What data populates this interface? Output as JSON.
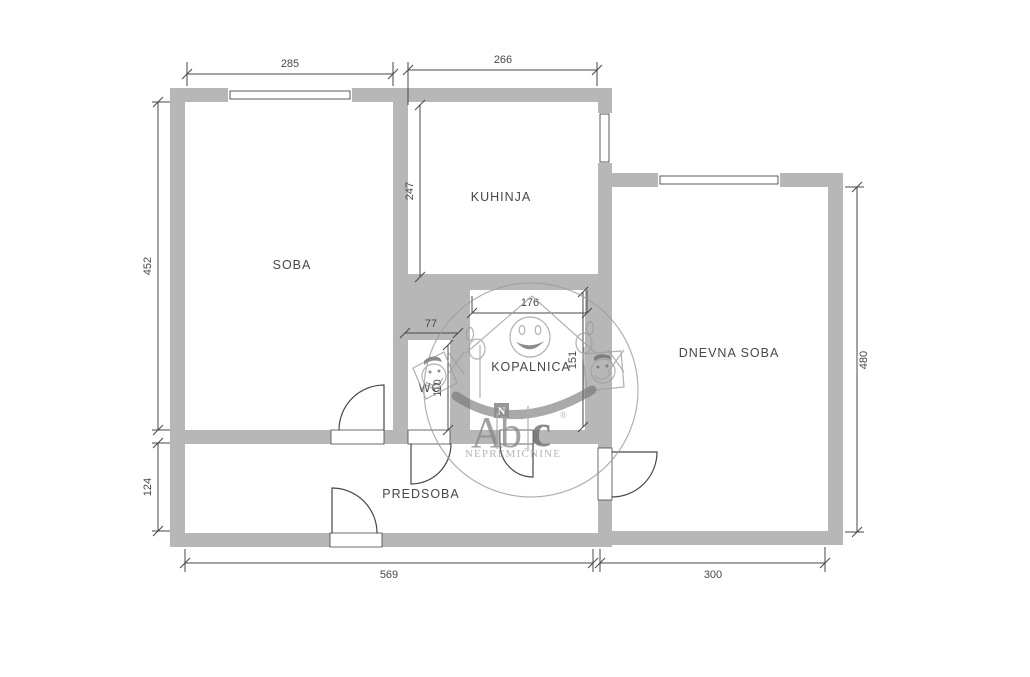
{
  "rooms": {
    "soba": "SOBA",
    "kuhinja": "KUHINJA",
    "kopalnica": "KOPALNICA",
    "wc": "WC",
    "predsoba": "PREDSOBA",
    "dnevna_soba": "DNEVNA SOBA"
  },
  "dims": {
    "soba_width": "285",
    "kuhinja_width": "266",
    "kuhinja_height": "247",
    "soba_height": "452",
    "predsoba_height": "124",
    "wc_width": "77",
    "kopalnica_width": "176",
    "wc_height": "110",
    "kopalnica_height": "151",
    "dnevna_height": "480",
    "bottom_left_width": "569",
    "bottom_right_width": "300"
  },
  "watermark": {
    "letter_a": "A",
    "letter_b": "b",
    "letter_c": "c",
    "registered": "®",
    "subtitle": "NEPREMIČNINE",
    "badge": "N"
  },
  "colors": {
    "wall": "#b7b7b7",
    "line": "#474747",
    "watermark": "#9d9d9d",
    "watermark_dark": "#6f6f6f",
    "background": "#ffffff"
  }
}
